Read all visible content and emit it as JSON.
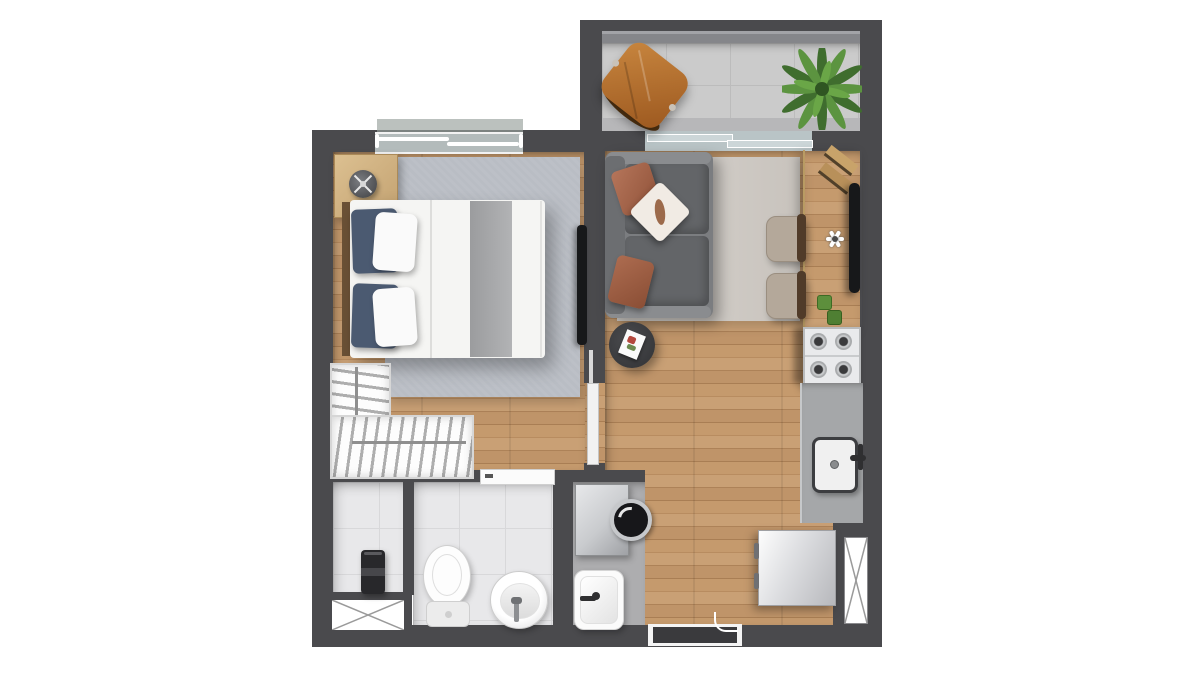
{
  "scene": {
    "type": "floor-plan",
    "description": "Top-down rendered floor plan of a studio apartment with balcony, bedroom, living/dining area, kitchen line, bathroom, service closet and laundry nook",
    "visible_text": [],
    "orientation": "balcony at top-right, entry door at bottom-center"
  },
  "palette": {
    "wall": "#4a4a4d",
    "wall_light": "#5b5b5f",
    "railing": "#8a8b8f",
    "wood": "#c0966a",
    "balcony_tile": "#cbcbcb",
    "tile_light": "#e8e8ea",
    "laundry_floor": "#adadaf",
    "rug_bedroom": "#b9bdc4",
    "rug_living": "#cfcac4",
    "counter_gray": "#a5a7a9",
    "counter_wood": "#d8bd8d",
    "sofa_base": "#7b7d80",
    "sofa_cushion": "#636568",
    "pillow_terracotta": "#a8674d",
    "pillow_blue": "#4b5a71",
    "bed_white": "#f5f5f3",
    "blanket_gray": "#a7a8aa",
    "chair_seat": "#b4a89a",
    "chair_back": "#503b29",
    "chair_orange_1": "#c8863f",
    "chair_orange_2": "#9c581f",
    "plant_dark": "#3f6d2e",
    "plant_light": "#5c9440",
    "tv": "#17181a",
    "fixture": "#f7f7f7",
    "glass": "#ccd6d8",
    "metal_light": "#e7e8ea",
    "metal_dark": "#9fa1a5",
    "heater": "#28282b"
  },
  "rooms": [
    {
      "id": "balcony",
      "name": "balcony",
      "items": [
        "butterfly-chair",
        "potted-plant",
        "glass-railing",
        "sliding-glass-door"
      ]
    },
    {
      "id": "bedroom",
      "name": "bedroom",
      "items": [
        "double-bed",
        "blue-pillows",
        "white-pillows",
        "gray-runner",
        "nightstand",
        "table-lamp",
        "area-rug",
        "wall-tv",
        "wardrobe-hangers",
        "sliding-window",
        "pocket-door"
      ]
    },
    {
      "id": "living-dining",
      "name": "living-dining",
      "items": [
        "sofa",
        "terracotta-pillows",
        "patterned-pillow",
        "area-rug",
        "coffee-table",
        "magazine",
        "dining-chair",
        "dining-chair",
        "wood-counter",
        "tv",
        "flower-decor",
        "green-cups",
        "cutting-boards"
      ]
    },
    {
      "id": "kitchen",
      "name": "kitchen",
      "items": [
        "cooktop-4-burner",
        "gray-countertop",
        "sink",
        "faucet",
        "refrigerator",
        "duct-shaft-x"
      ]
    },
    {
      "id": "bathroom",
      "name": "bathroom",
      "items": [
        "toilet",
        "round-basin",
        "faucet",
        "door"
      ]
    },
    {
      "id": "service",
      "name": "service-closet",
      "items": [
        "water-heater",
        "duct-shaft-x"
      ]
    },
    {
      "id": "laundry",
      "name": "laundry-nook",
      "items": [
        "washing-machine",
        "laundry-tub",
        "faucet"
      ]
    },
    {
      "id": "entry",
      "name": "entry",
      "items": [
        "entry-door",
        "door-handle"
      ]
    }
  ]
}
